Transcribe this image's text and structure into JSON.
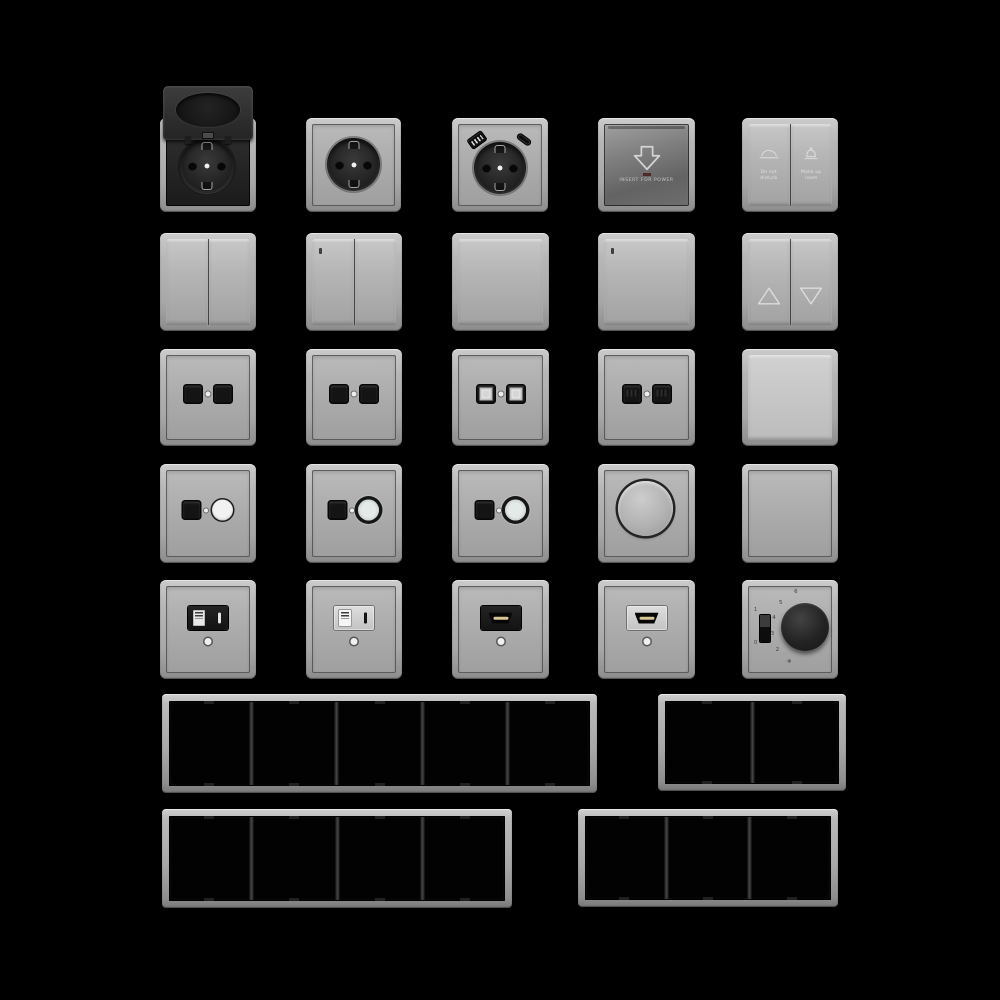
{
  "canvas": {
    "width": 1000,
    "height": 1000,
    "background": "#000000"
  },
  "palette": {
    "frame_gray": "#b0b0b0",
    "plate_gray": "#a8a8a8",
    "module_black": "#1b1b1b",
    "card_metal": "#6e6e6e",
    "hdmi_gold": "#d8c796",
    "indicator_white": "#f0f0f0"
  },
  "items": [
    {
      "name": "schuko-socket-flip-lid",
      "type": "socket_lid",
      "x": 160,
      "y": 118,
      "w": 96,
      "h": 94
    },
    {
      "name": "schuko-socket",
      "type": "socket",
      "x": 306,
      "y": 118,
      "w": 95,
      "h": 94
    },
    {
      "name": "schuko-socket-usb",
      "type": "socket_usb",
      "x": 452,
      "y": 118,
      "w": 96,
      "h": 94
    },
    {
      "name": "keycard-power-switch",
      "type": "card_switch",
      "x": 598,
      "y": 118,
      "w": 97,
      "h": 94,
      "label": "INSERT FOR POWER"
    },
    {
      "name": "hotel-service-switch",
      "type": "service_switch",
      "x": 742,
      "y": 118,
      "w": 96,
      "h": 94,
      "buttons": [
        {
          "icon": "do-not-disturb-icon",
          "label": "Do not\ndisturb"
        },
        {
          "icon": "make-up-room-icon",
          "label": "Make up\nroom"
        }
      ]
    },
    {
      "name": "rocker-switch-2gang",
      "type": "rocker2",
      "x": 160,
      "y": 233,
      "w": 96,
      "h": 98
    },
    {
      "name": "rocker-switch-2gang-indicator",
      "type": "rocker2",
      "led": true,
      "x": 306,
      "y": 233,
      "w": 96,
      "h": 98
    },
    {
      "name": "rocker-switch-1gang",
      "type": "rocker1",
      "x": 452,
      "y": 233,
      "w": 97,
      "h": 98
    },
    {
      "name": "rocker-switch-1gang-indicator",
      "type": "rocker1",
      "led": true,
      "x": 598,
      "y": 233,
      "w": 97,
      "h": 98
    },
    {
      "name": "shutter-switch",
      "type": "shutter",
      "x": 742,
      "y": 233,
      "w": 96,
      "h": 98,
      "icons": [
        "arrow-up-icon",
        "arrow-down-icon"
      ]
    },
    {
      "name": "data-outlet-2port-black",
      "type": "data2",
      "variant": "black",
      "x": 160,
      "y": 349,
      "w": 96,
      "h": 97
    },
    {
      "name": "data-outlet-2port-black-2",
      "type": "data2",
      "variant": "black",
      "x": 306,
      "y": 349,
      "w": 96,
      "h": 97
    },
    {
      "name": "data-outlet-2port-light",
      "type": "data2",
      "variant": "light",
      "x": 452,
      "y": 349,
      "w": 97,
      "h": 97
    },
    {
      "name": "data-outlet-2port-pins",
      "type": "data2",
      "variant": "detail",
      "x": 598,
      "y": 349,
      "w": 97,
      "h": 97
    },
    {
      "name": "rocker-switch-plain",
      "type": "rocker1",
      "plain": true,
      "x": 742,
      "y": 349,
      "w": 96,
      "h": 97
    },
    {
      "name": "tv-data-outlet-white",
      "type": "tv_data",
      "variant": "white",
      "x": 160,
      "y": 464,
      "w": 96,
      "h": 99
    },
    {
      "name": "tv-data-outlet-ring",
      "type": "tv_data",
      "variant": "ring",
      "x": 306,
      "y": 464,
      "w": 96,
      "h": 99
    },
    {
      "name": "tv-data-outlet-ring-2",
      "type": "tv_data",
      "variant": "ring",
      "x": 452,
      "y": 464,
      "w": 97,
      "h": 99
    },
    {
      "name": "rotary-dimmer",
      "type": "dimmer",
      "x": 598,
      "y": 464,
      "w": 97,
      "h": 99
    },
    {
      "name": "blank-cover-plate",
      "type": "blank",
      "x": 742,
      "y": 464,
      "w": 96,
      "h": 99
    },
    {
      "name": "usb-charger-outlet-black",
      "type": "usb_outlet",
      "variant": "black",
      "x": 160,
      "y": 580,
      "w": 96,
      "h": 99
    },
    {
      "name": "usb-charger-outlet-light",
      "type": "usb_outlet",
      "variant": "light",
      "x": 306,
      "y": 580,
      "w": 96,
      "h": 99
    },
    {
      "name": "hdmi-outlet-black",
      "type": "hdmi",
      "variant": "black",
      "x": 452,
      "y": 580,
      "w": 97,
      "h": 99
    },
    {
      "name": "hdmi-outlet-light",
      "type": "hdmi",
      "variant": "light",
      "x": 598,
      "y": 580,
      "w": 97,
      "h": 99
    },
    {
      "name": "thermostat-dial",
      "type": "thermostat",
      "x": 742,
      "y": 580,
      "w": 96,
      "h": 99,
      "scale": [
        "6",
        "5",
        "4",
        "3",
        "2",
        "❄"
      ],
      "switch_labels": [
        "1",
        "0"
      ]
    },
    {
      "name": "frame-5gang",
      "type": "frame",
      "gangs": 5,
      "x": 162,
      "y": 694,
      "w": 435,
      "h": 99
    },
    {
      "name": "frame-2gang",
      "type": "frame",
      "gangs": 2,
      "x": 658,
      "y": 694,
      "w": 188,
      "h": 97
    },
    {
      "name": "frame-4gang",
      "type": "frame",
      "gangs": 4,
      "x": 162,
      "y": 809,
      "w": 350,
      "h": 99
    },
    {
      "name": "frame-3gang",
      "type": "frame",
      "gangs": 3,
      "x": 578,
      "y": 809,
      "w": 260,
      "h": 98
    }
  ]
}
